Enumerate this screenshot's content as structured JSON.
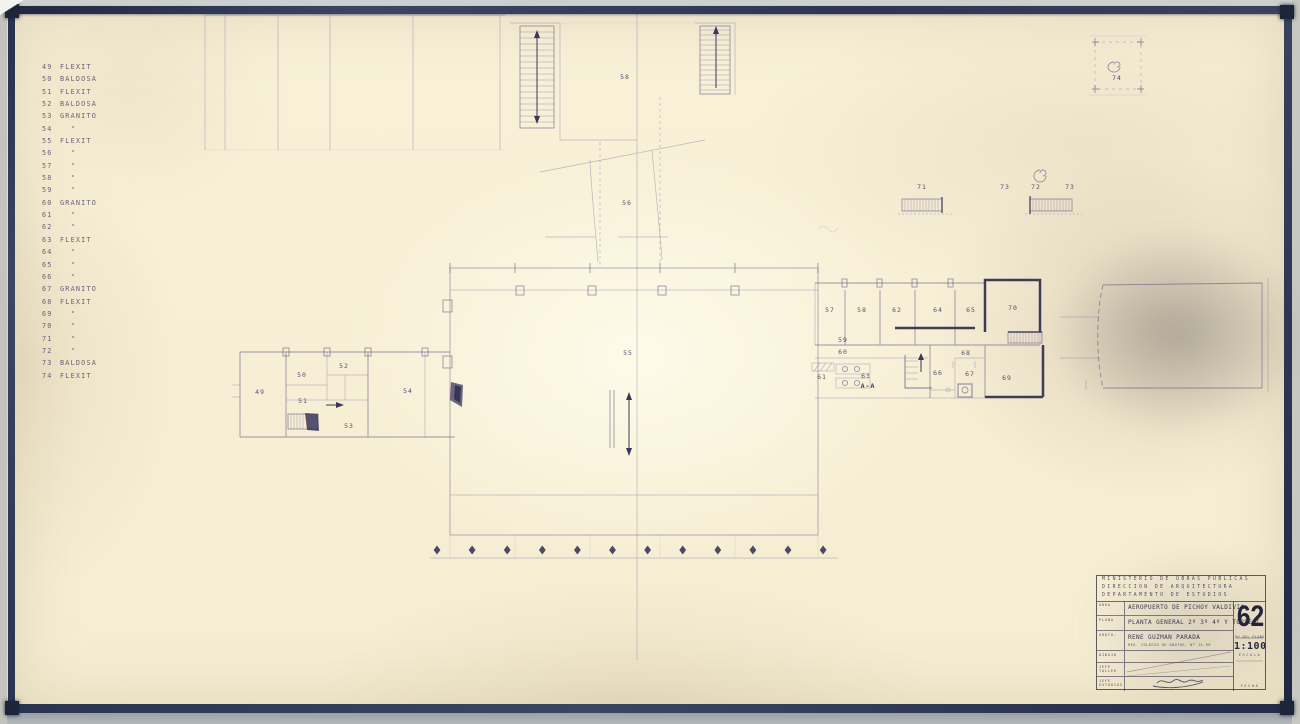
{
  "sheet": {
    "paper_color": "#f8f1d8",
    "frame_color": "#2e3850",
    "ink_color": "#3e3a5c",
    "description": "Scanned architectural blueprint sheet"
  },
  "legend": {
    "items": [
      {
        "num": "49",
        "material": "FLEXIT"
      },
      {
        "num": "50",
        "material": "BALDOSA"
      },
      {
        "num": "51",
        "material": "FLEXIT"
      },
      {
        "num": "52",
        "material": "BALDOSA"
      },
      {
        "num": "53",
        "material": "GRANITO"
      },
      {
        "num": "54",
        "material": "\""
      },
      {
        "num": "55",
        "material": "FLEXIT"
      },
      {
        "num": "56",
        "material": "\""
      },
      {
        "num": "57",
        "material": "\""
      },
      {
        "num": "58",
        "material": "\""
      },
      {
        "num": "59",
        "material": "\""
      },
      {
        "num": "60",
        "material": "GRANITO"
      },
      {
        "num": "61",
        "material": "\""
      },
      {
        "num": "62",
        "material": "\""
      },
      {
        "num": "63",
        "material": "FLEXIT"
      },
      {
        "num": "64",
        "material": "\""
      },
      {
        "num": "65",
        "material": "\""
      },
      {
        "num": "66",
        "material": "\""
      },
      {
        "num": "67",
        "material": "GRANITO"
      },
      {
        "num": "68",
        "material": "FLEXIT"
      },
      {
        "num": "69",
        "material": "\""
      },
      {
        "num": "70",
        "material": "\""
      },
      {
        "num": "71",
        "material": "\""
      },
      {
        "num": "72",
        "material": "\""
      },
      {
        "num": "73",
        "material": "BALDOSA"
      },
      {
        "num": "74",
        "material": "FLEXIT"
      }
    ]
  },
  "plan": {
    "labels": [
      {
        "text": "58",
        "x": 625,
        "y": 77
      },
      {
        "text": "56",
        "x": 627,
        "y": 203
      },
      {
        "text": "55",
        "x": 628,
        "y": 353
      },
      {
        "text": "49",
        "x": 260,
        "y": 392
      },
      {
        "text": "50",
        "x": 302,
        "y": 375
      },
      {
        "text": "51",
        "x": 303,
        "y": 401
      },
      {
        "text": "52",
        "x": 344,
        "y": 366
      },
      {
        "text": "53",
        "x": 349,
        "y": 426
      },
      {
        "text": "54",
        "x": 408,
        "y": 391
      },
      {
        "text": "57",
        "x": 830,
        "y": 310
      },
      {
        "text": "58",
        "x": 862,
        "y": 310
      },
      {
        "text": "62",
        "x": 897,
        "y": 310
      },
      {
        "text": "64",
        "x": 938,
        "y": 310
      },
      {
        "text": "65",
        "x": 971,
        "y": 310
      },
      {
        "text": "70",
        "x": 1013,
        "y": 308
      },
      {
        "text": "59",
        "x": 843,
        "y": 340
      },
      {
        "text": "60",
        "x": 843,
        "y": 352
      },
      {
        "text": "61",
        "x": 822,
        "y": 377
      },
      {
        "text": "63",
        "x": 866,
        "y": 376
      },
      {
        "text": "A-A",
        "x": 868,
        "y": 386,
        "sec": true
      },
      {
        "text": "66",
        "x": 938,
        "y": 373
      },
      {
        "text": "68",
        "x": 966,
        "y": 353
      },
      {
        "text": "67",
        "x": 970,
        "y": 374
      },
      {
        "text": "69",
        "x": 1007,
        "y": 378
      },
      {
        "text": "71",
        "x": 922,
        "y": 187
      },
      {
        "text": "73",
        "x": 1005,
        "y": 187
      },
      {
        "text": "72",
        "x": 1036,
        "y": 187
      },
      {
        "text": "73",
        "x": 1070,
        "y": 187
      },
      {
        "text": "74",
        "x": 1117,
        "y": 78
      }
    ],
    "column_markers": {
      "count": 12,
      "x_start": 437,
      "x_step": 35.1,
      "y": 550
    }
  },
  "titleblock": {
    "agency_lines": [
      "MINISTERIO DE OBRAS PUBLICAS",
      "DIRECCION DE ARQUITECTURA",
      "DEPARTAMENTO DE ESTUDIOS"
    ],
    "rows": [
      {
        "label": "OBRA",
        "value": "AEROPUERTO DE PICHOY VALDIVIA",
        "value2": ""
      },
      {
        "label": "PLANO",
        "value": "PLANTA GENERAL 2º 3º 4º Y TORRE C.",
        "value2": ""
      },
      {
        "label": "ARQTO.",
        "value": "RENE GUZMAN PARADA",
        "value2": "REG. COLEGIO DE ARQTOS. Nº 14-99"
      },
      {
        "label": "DIBUJO",
        "value": "",
        "value2": ""
      },
      {
        "label": "JEFE TALLER",
        "value": "",
        "value2": ""
      },
      {
        "label": "JEFE ESTUDIOS",
        "value": "",
        "value2": ""
      }
    ],
    "plan_number": "62",
    "plan_number_caption": "Nº DEL PLANO",
    "scale_value": "1:100",
    "scale_caption": "ESCALA",
    "date_caption": "FECHA"
  }
}
